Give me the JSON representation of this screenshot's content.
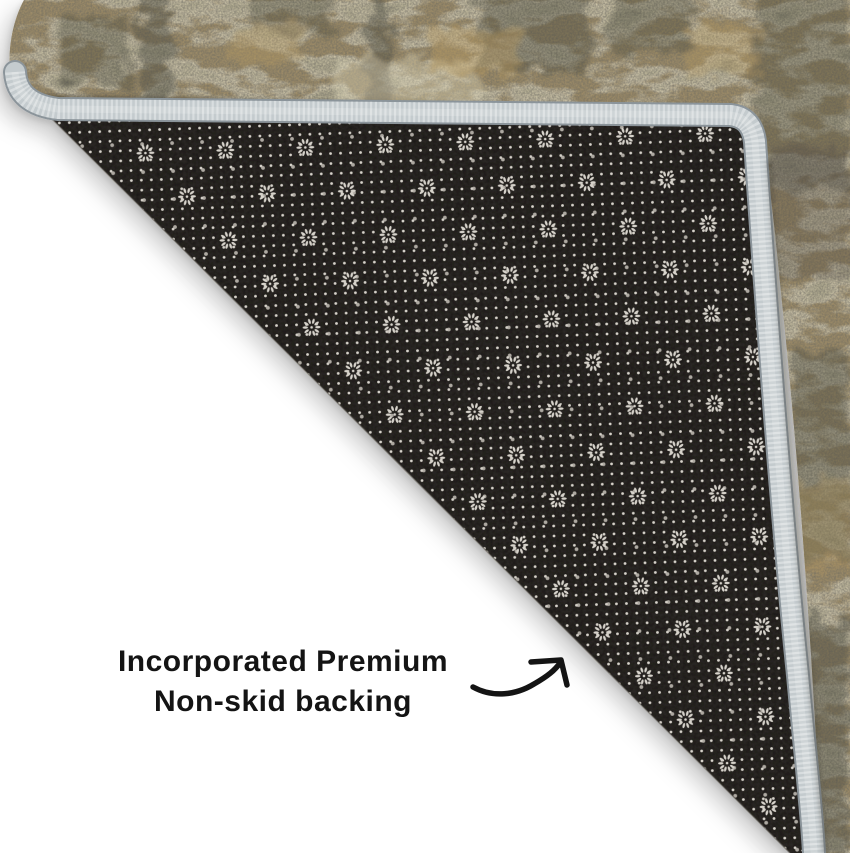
{
  "scene": {
    "type": "product-photo",
    "subject": "Area rug corner folded over revealing non-skid backing",
    "background_color": "#ffffff"
  },
  "annotation": {
    "line1": "Incorporated Premium",
    "line2": "Non-skid backing",
    "text_color": "#141414",
    "arrow_icon": "curved-arrow-up-right"
  },
  "rug": {
    "face_style": "distressed vintage beige-gray pile",
    "face_base_color": "#c4bda6",
    "backing_color": "#1b1816",
    "backing_dot_color": "#d7d3cb",
    "binding_color": "#c4cbce",
    "binding_edge_color": "#8b949a",
    "shadow_color": "#000000"
  }
}
